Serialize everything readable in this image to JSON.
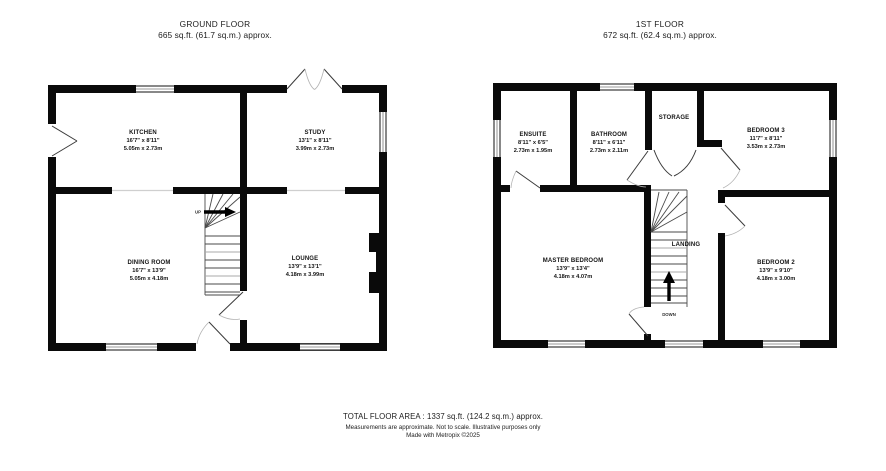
{
  "colors": {
    "background": "#ffffff",
    "wall": "#0a0a0a",
    "door_leaf": "#3a3a3a",
    "door_arc": "#b2b2b2",
    "window_mid": "#9a9a9a",
    "text": "#1c1c1c"
  },
  "ground_floor": {
    "title": "GROUND FLOOR",
    "subtitle": "665 sq.ft. (61.7 sq.m.) approx.",
    "stair_label": "UP",
    "rooms": [
      {
        "name": "KITCHEN",
        "dims_ft": "16'7\" x 8'11\"",
        "dims_m": "5.05m x 2.73m"
      },
      {
        "name": "STUDY",
        "dims_ft": "13'1\" x 8'11\"",
        "dims_m": "3.99m x 2.73m"
      },
      {
        "name": "DINING ROOM",
        "dims_ft": "16'7\" x 13'9\"",
        "dims_m": "5.05m x 4.18m"
      },
      {
        "name": "LOUNGE",
        "dims_ft": "13'9\" x 13'1\"",
        "dims_m": "4.18m x 3.99m"
      }
    ]
  },
  "first_floor": {
    "title": "1ST FLOOR",
    "subtitle": "672 sq.ft. (62.4 sq.m.) approx.",
    "stair_label": "DOWN",
    "rooms": [
      {
        "name": "ENSUITE",
        "dims_ft": "8'11\" x 6'5\"",
        "dims_m": "2.73m x 1.95m"
      },
      {
        "name": "BATHROOM",
        "dims_ft": "8'11\" x 6'11\"",
        "dims_m": "2.73m x 2.11m"
      },
      {
        "name": "STORAGE"
      },
      {
        "name": "BEDROOM 3",
        "dims_ft": "11'7\" x 8'11\"",
        "dims_m": "3.53m x 2.73m"
      },
      {
        "name": "MASTER BEDROOM",
        "dims_ft": "13'9\" x 13'4\"",
        "dims_m": "4.18m x 4.07m"
      },
      {
        "name": "BEDROOM 2",
        "dims_ft": "13'9\" x 9'10\"",
        "dims_m": "4.18m x 3.00m"
      },
      {
        "name": "LANDING"
      }
    ]
  },
  "footer": {
    "total": "TOTAL FLOOR AREA : 1337 sq.ft. (124.2 sq.m.) approx.",
    "disclaimer": "Measurements are approximate.  Not to scale.  Illustrative purposes only",
    "credit": "Made with Metropix ©2025"
  }
}
